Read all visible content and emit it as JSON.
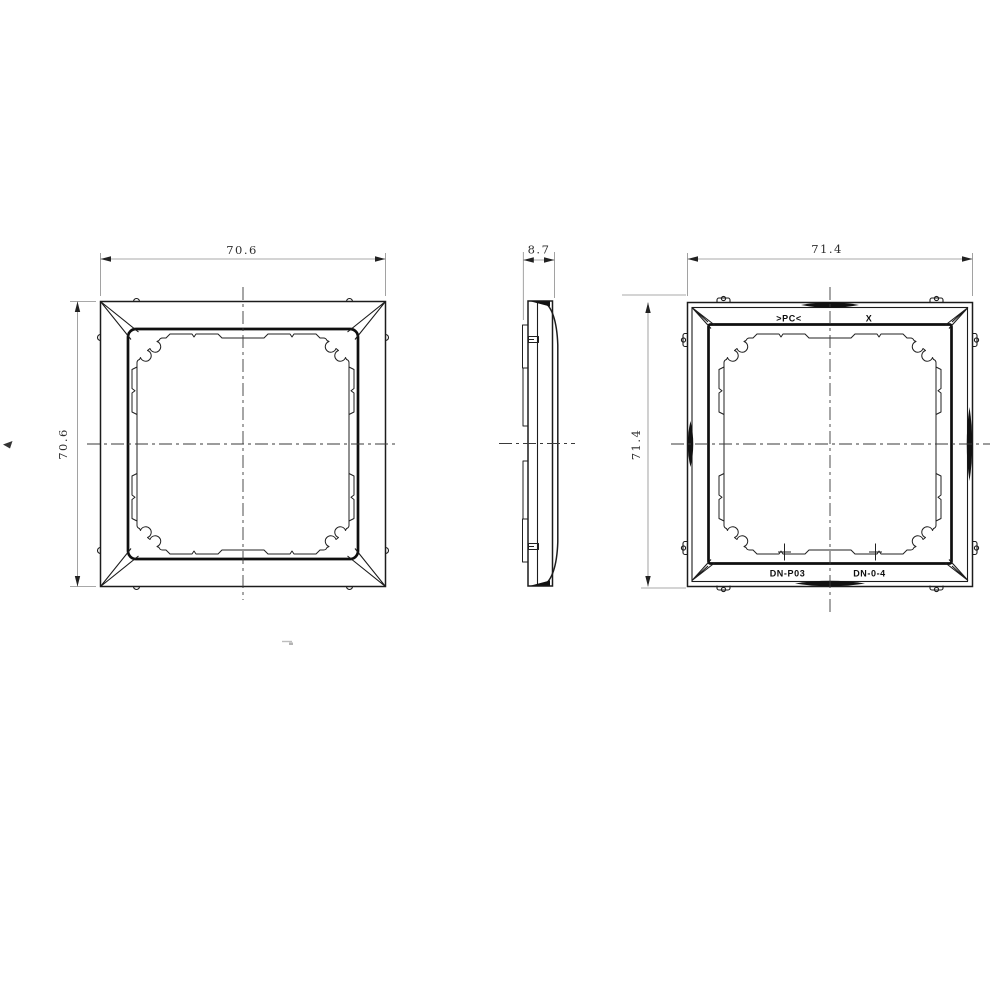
{
  "drawing": {
    "type": "technical-orthographic-drawing",
    "subject": "single-gang cover frame (wall plate)",
    "background_color": "#ffffff",
    "line_color": "#1c1c1c",
    "dim_line_color": "#8c8c8c",
    "dims": {
      "front_width": "70.6",
      "front_height": "70.6",
      "side_thickness": "8.7",
      "back_width": "71.4",
      "back_height": "71.4"
    },
    "back_markings": {
      "material": ">PC<",
      "cavity": "X",
      "part_no": "DN-P03",
      "mold_no": "DN-0-4"
    }
  }
}
